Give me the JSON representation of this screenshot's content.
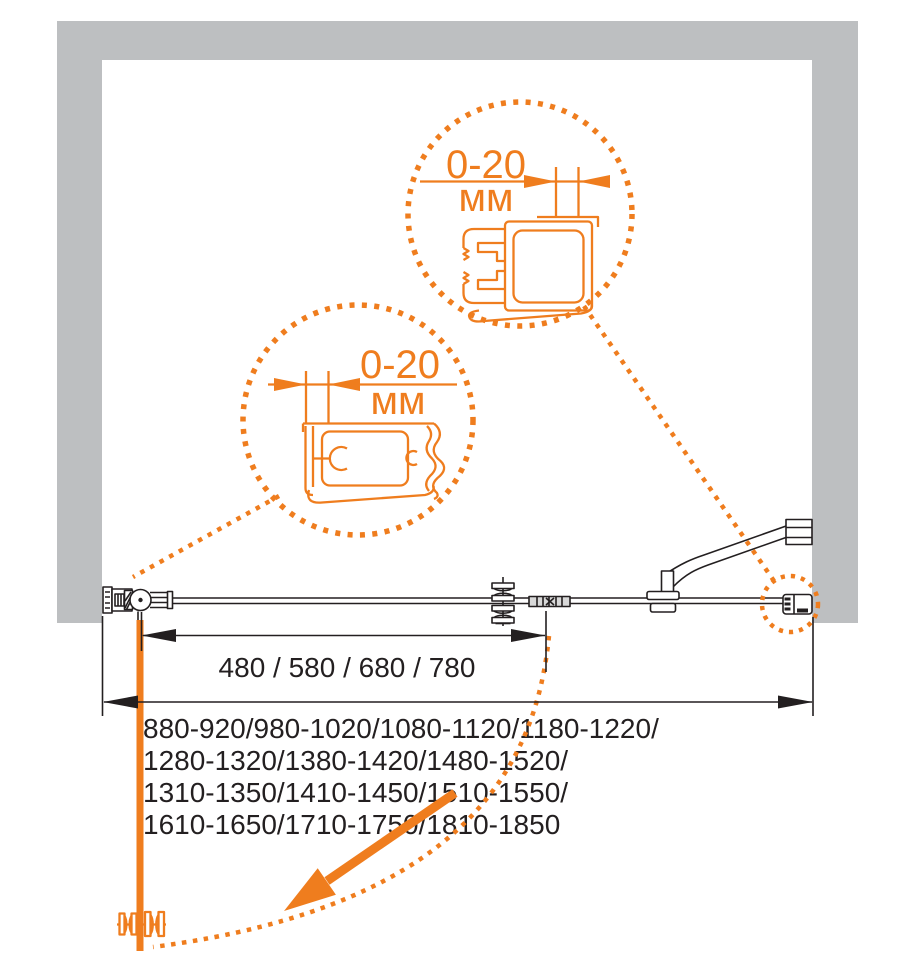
{
  "page": {
    "background": "#ffffff"
  },
  "colors": {
    "accent": "#EF7D1E",
    "wall_gray": "#BDBFC1",
    "ink": "#231F20"
  },
  "detail_callouts": {
    "top": {
      "value": "0-20",
      "unit": "мм"
    },
    "bottom": {
      "value": "0-20",
      "unit": "мм"
    }
  },
  "dimensions": {
    "door_width_options": "480 / 580 / 680 / 780",
    "opening_width_ranges": [
      "880-920/980-1020/1080-1120/1180-1220/",
      "1280-1320/1380-1420/1480-1520/",
      "1310-1350/1410-1450/1510-1550/",
      "1610-1650/1710-1750/1810-1850"
    ]
  },
  "icons": {
    "detail_top": "wall-profile-cross-section-icon",
    "detail_bottom": "wall-profile-cross-section-icon",
    "hinge": "pivot-hinge-icon",
    "handle": "knob-handle-icon",
    "latch": "magnetic-latch-icon",
    "support": "support-bar-icon",
    "swing": "door-swing-arrow-icon"
  }
}
